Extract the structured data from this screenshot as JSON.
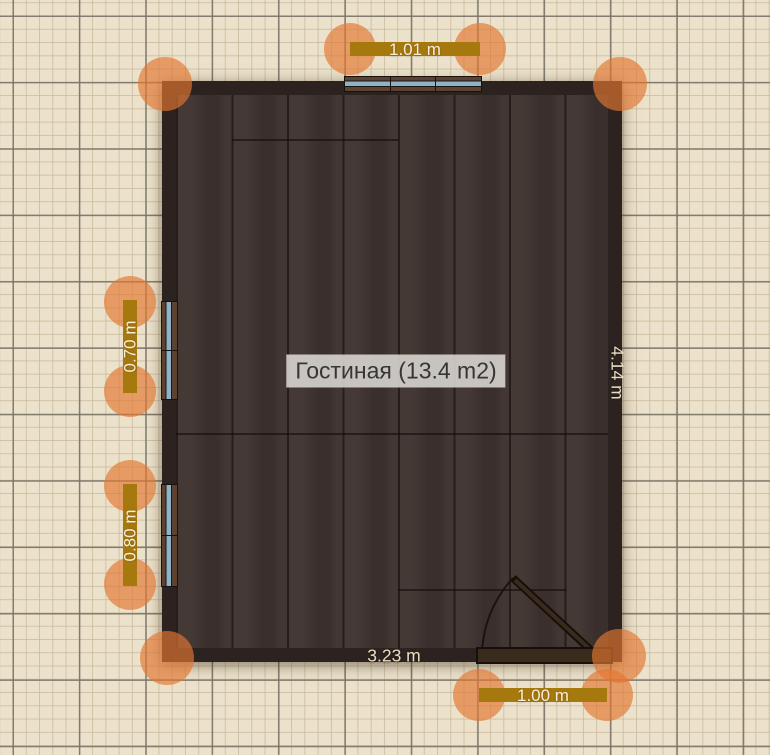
{
  "room": {
    "name_label": "Гостиная (13.4 m2)",
    "bottom_length_label": "3.23 m",
    "right_length_label": "4.14 m"
  },
  "dimensions": {
    "top_window_length": "1.01 m",
    "left_upper_window_length": "0.70 m",
    "left_lower_window_length": "0.80 m",
    "door_width": "1.00 m"
  },
  "colors": {
    "handle": "#e27730",
    "dimension_bar": "#a6790f",
    "wall": "#2c2320",
    "floor": "#3f3330",
    "glass": "#8fb3c6",
    "grid_background": "#ece2cb"
  }
}
